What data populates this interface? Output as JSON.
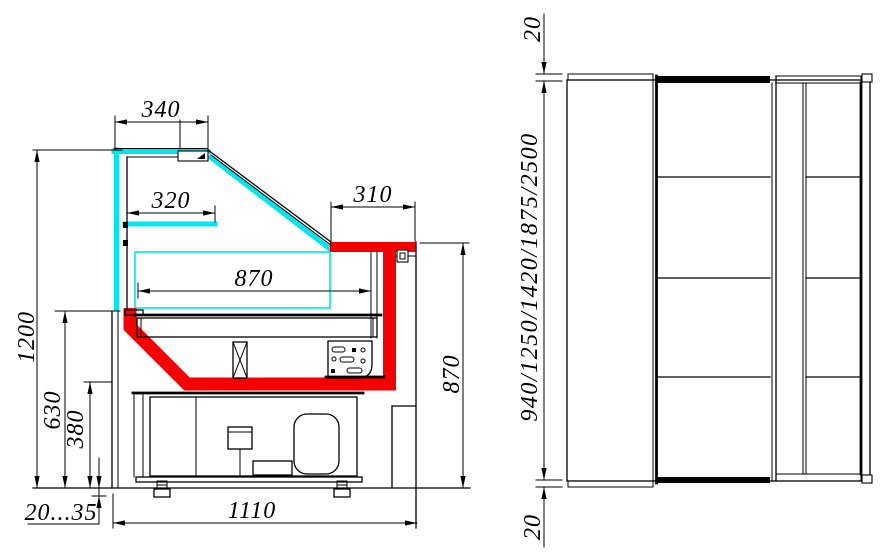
{
  "side_view": {
    "name": "cross-section view of display case",
    "dims": {
      "d340": "340",
      "d320": "320",
      "d310": "310",
      "d870w": "870",
      "d1200": "1200",
      "d630": "630",
      "d380": "380",
      "dfeet": "20...35",
      "d1110": "1110",
      "d870h": "870"
    }
  },
  "front_view": {
    "name": "front view of display case",
    "dims": {
      "d20top": "20",
      "dlengths": "940/1250/1420/1875/2500",
      "d20bot": "20"
    }
  },
  "colors": {
    "glass": "#00e6ee",
    "accent": "#f40000",
    "line": "#000000",
    "background": "#ffffff"
  }
}
